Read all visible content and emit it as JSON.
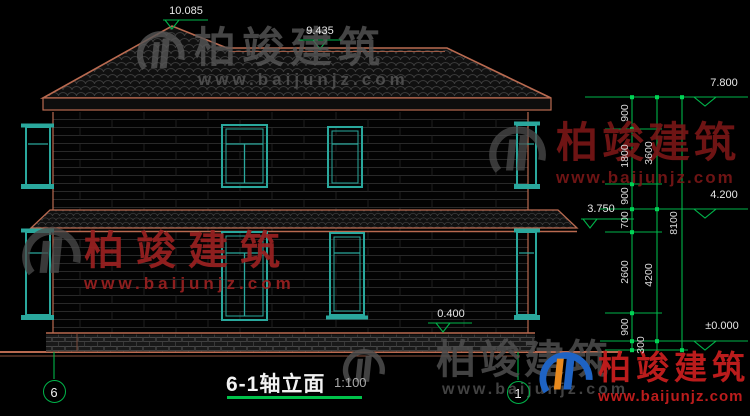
{
  "title": {
    "text": "6-1轴立面",
    "scale": "1:100"
  },
  "axes": {
    "left": "6",
    "right": "1"
  },
  "levels": {
    "peak": "10.085",
    "ridge": "9.435",
    "eave": "7.800",
    "floor2": "4.200",
    "canopy": "3.750",
    "plinth": "0.400",
    "ground": "±0.000"
  },
  "dims": {
    "col1": [
      "900",
      "1800",
      "900",
      "700",
      "2600",
      "900",
      "300"
    ],
    "col2": [
      "3600",
      "4200"
    ],
    "col3": [
      "8100"
    ]
  },
  "watermark": {
    "brand": "柏竣建筑",
    "site": "www.baijunjz.com"
  },
  "colors": {
    "background": "#000000",
    "outline_salmon": "#b96a50",
    "dimension_green": "#00b44a",
    "window_teal": "#2aa89d",
    "text_white": "#e8e8e8",
    "watermark_gray": "#575757",
    "watermark_dark_red": "#7a1717",
    "watermark_bright_red": "#c21d1d"
  }
}
